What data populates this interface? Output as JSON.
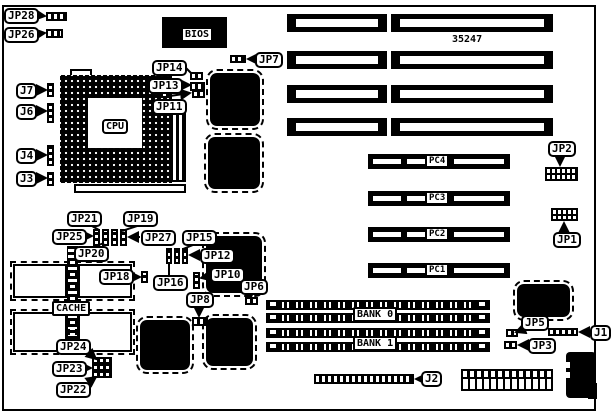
{
  "part_number": "35247",
  "chip_labels": {
    "cpu": "CPU",
    "bios": "BIOS",
    "cache": "CACHE",
    "bank0": "BANK 0",
    "bank1": "BANK 1"
  },
  "slot_labels": {
    "pc4": "PC4",
    "pc3": "PC3",
    "pc2": "PC2",
    "pc1": "PC1"
  },
  "callouts": {
    "jp28": "JP28",
    "jp26": "JP26",
    "j7": "J7",
    "j6": "J6",
    "j4": "J4",
    "j3": "J3",
    "jp14": "JP14",
    "jp13": "JP13",
    "jp11": "JP11",
    "jp7": "JP7",
    "jp21": "JP21",
    "jp19": "JP19",
    "jp25": "JP25",
    "jp27": "JP27",
    "jp20": "JP20",
    "jp18": "JP18",
    "jp16": "JP16",
    "jp15": "JP15",
    "jp12": "JP12",
    "jp10": "JP10",
    "jp8": "JP8",
    "jp6": "JP6",
    "jp24": "JP24",
    "jp23": "JP23",
    "jp22": "JP22",
    "jp2": "JP2",
    "jp1": "JP1",
    "jp5": "JP5",
    "jp3": "JP3",
    "j1": "J1",
    "j2": "J2"
  },
  "colors": {
    "ink": "#000000",
    "paper": "#ffffff"
  }
}
